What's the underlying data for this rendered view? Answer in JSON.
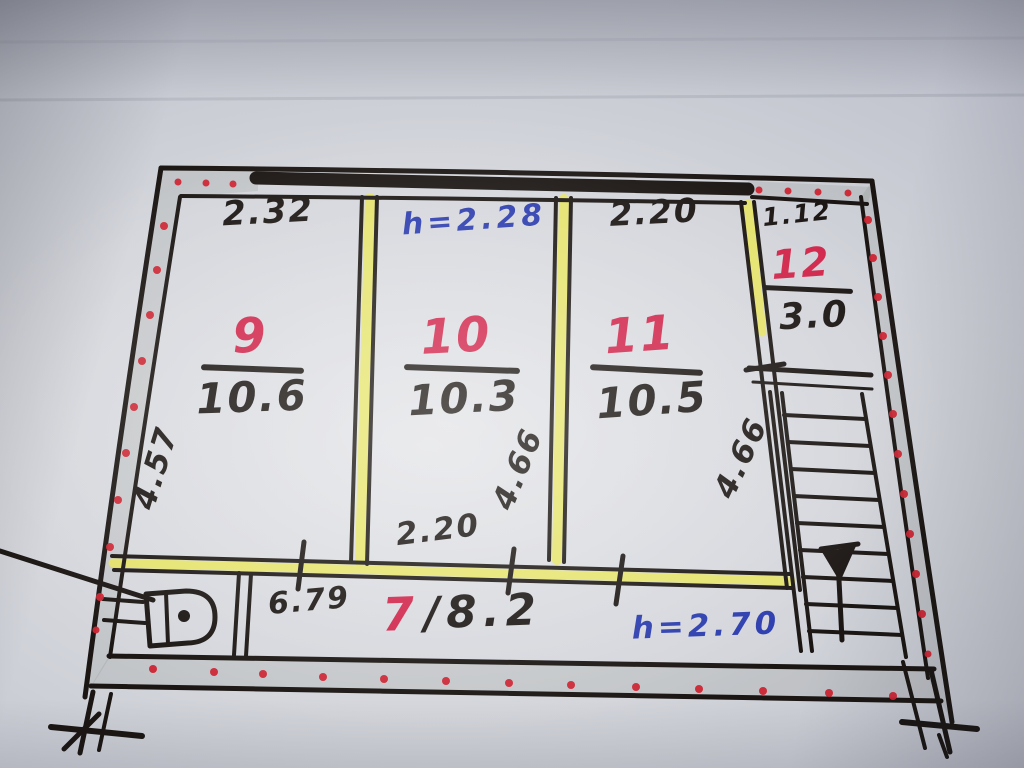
{
  "colors": {
    "paper": "#c6cad2",
    "ink": "#1b1613",
    "red": "#d6234a",
    "red_dot": "#d32330",
    "blue": "#2a3cb2",
    "highlight": "#e8e64c"
  },
  "plan": {
    "left_wall_dim": "4.57",
    "rooms": [
      {
        "number": "9",
        "area": "10.6",
        "top_dim": "2.32"
      },
      {
        "number": "10",
        "area": "10.3",
        "ceiling_height": "h=2.28",
        "bottom_dim": "2.20",
        "side_dim": "4.66"
      },
      {
        "number": "11",
        "area": "10.5",
        "top_dim": "2.20",
        "side_dim": "4.66"
      },
      {
        "number": "12",
        "area": "3.0",
        "top_dim": "1.12"
      },
      {
        "number": "7",
        "area_label": "/8.2",
        "ceiling_height": "h=2.70",
        "width_dim": "6.79"
      }
    ]
  }
}
